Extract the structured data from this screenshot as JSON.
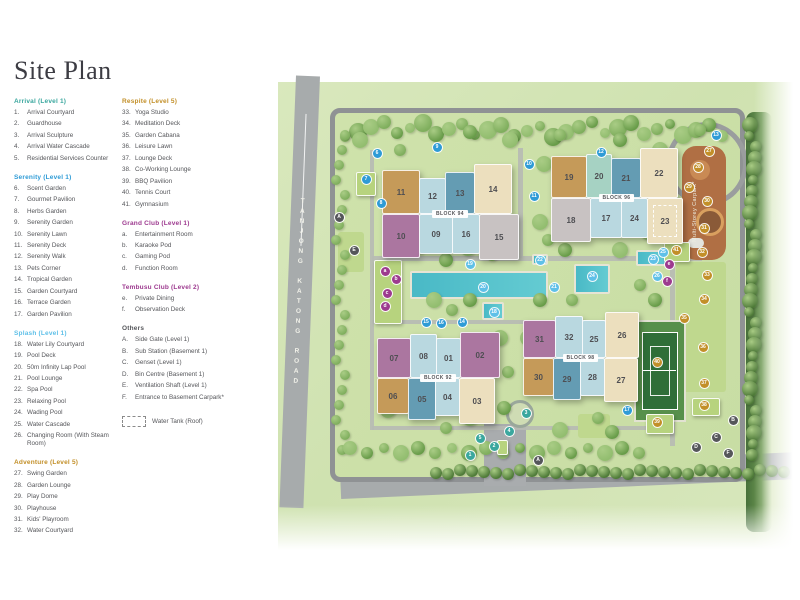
{
  "title": "Site Plan",
  "colors": {
    "arrival": "#3aa79e",
    "serenity": "#2e9bd6",
    "splash": "#5fc0e8",
    "leisure": "#c28f28",
    "club": "#9d3a8f",
    "others": "#55565a",
    "wing_tan": "#c59a59",
    "wing_lightblue": "#b9d8e0",
    "wing_blue": "#649cb3",
    "wing_teal": "#a6d2c3",
    "wing_cream": "#ecdfbe",
    "wing_purple": "#ab76a0",
    "wing_gray": "#c8c2c2"
  },
  "legend": {
    "water_tank_label": "Water Tank (Roof)",
    "columns": [
      [
        {
          "title": "Arrival (Level 1)",
          "color": "arrival",
          "items": [
            [
              "1",
              "Arrival Courtyard"
            ],
            [
              "2",
              "Guardhouse"
            ],
            [
              "3",
              "Arrival Sculpture"
            ],
            [
              "4",
              "Arrival Water Cascade"
            ],
            [
              "5",
              "Residential Services Counter"
            ]
          ]
        },
        {
          "title": "Serenity (Level 1)",
          "color": "serenity",
          "items": [
            [
              "6",
              "Scent Garden"
            ],
            [
              "7",
              "Gourmet Pavilion"
            ],
            [
              "8",
              "Herbs Garden"
            ],
            [
              "9",
              "Serenity Garden"
            ],
            [
              "10",
              "Serenity Lawn"
            ],
            [
              "11",
              "Serenity Deck"
            ],
            [
              "12",
              "Serenity Walk"
            ],
            [
              "13",
              "Pets Corner"
            ],
            [
              "14",
              "Tropical Garden"
            ],
            [
              "15",
              "Garden Courtyard"
            ],
            [
              "16",
              "Terrace Garden"
            ],
            [
              "17",
              "Garden Pavilion"
            ]
          ]
        },
        {
          "title": "Splash (Level 1)",
          "color": "splash",
          "items": [
            [
              "18",
              "Water Lily Courtyard"
            ],
            [
              "19",
              "Pool Deck"
            ],
            [
              "20",
              "50m Infinity Lap Pool"
            ],
            [
              "21",
              "Pool Lounge"
            ],
            [
              "22",
              "Spa Pool"
            ],
            [
              "23",
              "Relaxing Pool"
            ],
            [
              "24",
              "Wading Pool"
            ],
            [
              "25",
              "Water Cascade"
            ],
            [
              "26",
              "Changing Room (With Steam Room)"
            ]
          ]
        },
        {
          "title": "Adventure (Level 5)",
          "color": "leisure",
          "items": [
            [
              "27",
              "Swing Garden"
            ],
            [
              "28",
              "Garden Lounge"
            ],
            [
              "29",
              "Play Dome"
            ],
            [
              "30",
              "Playhouse"
            ],
            [
              "31",
              "Kids' Playroom"
            ],
            [
              "32",
              "Water Courtyard"
            ]
          ]
        }
      ],
      [
        {
          "title": "Respite (Level 5)",
          "color": "leisure",
          "items": [
            [
              "33",
              "Yoga Studio"
            ],
            [
              "34",
              "Meditation Deck"
            ],
            [
              "35",
              "Garden Cabana"
            ],
            [
              "36",
              "Leisure Lawn"
            ],
            [
              "37",
              "Lounge Deck"
            ],
            [
              "38",
              "Co-Working Lounge"
            ],
            [
              "39",
              "BBQ Pavilion"
            ],
            [
              "40",
              "Tennis Court"
            ],
            [
              "41",
              "Gymnasium"
            ]
          ]
        },
        {
          "title": "Grand Club (Level 1)",
          "color": "club",
          "items": [
            [
              "a",
              "Entertainment Room"
            ],
            [
              "b",
              "Karaoke Pod"
            ],
            [
              "c",
              "Gaming Pod"
            ],
            [
              "d",
              "Function Room"
            ]
          ]
        },
        {
          "title": "Tembusu Club (Level 2)",
          "color": "club",
          "items": [
            [
              "e",
              "Private Dining"
            ],
            [
              "f",
              "Observation Deck"
            ]
          ]
        },
        {
          "title": "Others",
          "color": "others",
          "items": [
            [
              "A",
              "Side Gate (Level 1)"
            ],
            [
              "B",
              "Sub Station (Basement 1)"
            ],
            [
              "C",
              "Genset (Level 1)"
            ],
            [
              "D",
              "Bin Centre (Basement 1)"
            ],
            [
              "E",
              "Ventilation Shaft (Level 1)"
            ],
            [
              "F",
              "Entrance to Basement Carpark*"
            ]
          ]
        }
      ]
    ]
  },
  "map": {
    "road_left_label": "TANJONG KATONG ROAD",
    "road_bottom_label": "JALAN TEMBUSU",
    "carpark_label": "Multi-Storey Carpark*",
    "blocks": [
      {
        "name": "BLOCK 94",
        "x": 382,
        "y": 164,
        "top": [
          {
            "n": "11",
            "c": "tan",
            "w": 38,
            "h": 44
          },
          {
            "n": "12",
            "c": "lightblue",
            "w": 27,
            "h": 36
          },
          {
            "n": "13",
            "c": "blue",
            "w": 30,
            "h": 42
          },
          {
            "n": "14",
            "c": "cream",
            "w": 38,
            "h": 50
          }
        ],
        "bottom": [
          {
            "n": "10",
            "c": "purple",
            "w": 38,
            "h": 44
          },
          {
            "n": "09",
            "c": "lightblue",
            "w": 34,
            "h": 40
          },
          {
            "n": "16",
            "c": "lightblue",
            "w": 28,
            "h": 40
          },
          {
            "n": "15",
            "c": "gray",
            "w": 40,
            "h": 46
          }
        ]
      },
      {
        "name": "BLOCK 96",
        "x": 551,
        "y": 148,
        "top": [
          {
            "n": "19",
            "c": "tan",
            "w": 36,
            "h": 42
          },
          {
            "n": "20",
            "c": "teal",
            "w": 26,
            "h": 44
          },
          {
            "n": "21",
            "c": "blue",
            "w": 30,
            "h": 40
          },
          {
            "n": "22",
            "c": "cream",
            "w": 38,
            "h": 50
          }
        ],
        "bottom": [
          {
            "n": "18",
            "c": "gray",
            "w": 40,
            "h": 44
          },
          {
            "n": "17",
            "c": "lightblue",
            "w": 32,
            "h": 40
          },
          {
            "n": "24",
            "c": "lightblue",
            "w": 27,
            "h": 40
          },
          {
            "n": "23",
            "c": "cream",
            "w": 36,
            "h": 46,
            "dashed": true
          }
        ]
      },
      {
        "name": "BLOCK 92",
        "x": 377,
        "y": 332,
        "top": [
          {
            "n": "07",
            "c": "purple",
            "w": 34,
            "h": 40
          },
          {
            "n": "08",
            "c": "lightblue",
            "w": 27,
            "h": 44
          },
          {
            "n": "01",
            "c": "lightblue",
            "w": 25,
            "h": 40
          },
          {
            "n": "02",
            "c": "purple",
            "w": 40,
            "h": 46
          }
        ],
        "bottom": [
          {
            "n": "06",
            "c": "tan",
            "w": 32,
            "h": 36
          },
          {
            "n": "05",
            "c": "blue",
            "w": 28,
            "h": 42
          },
          {
            "n": "04",
            "c": "lightblue",
            "w": 25,
            "h": 38
          },
          {
            "n": "03",
            "c": "cream",
            "w": 36,
            "h": 46
          }
        ]
      },
      {
        "name": "BLOCK 98",
        "x": 523,
        "y": 312,
        "top": [
          {
            "n": "31",
            "c": "purple",
            "w": 33,
            "h": 38
          },
          {
            "n": "32",
            "c": "lightblue",
            "w": 28,
            "h": 42
          },
          {
            "n": "25",
            "c": "lightblue",
            "w": 24,
            "h": 38
          },
          {
            "n": "26",
            "c": "cream",
            "w": 34,
            "h": 46
          }
        ],
        "bottom": [
          {
            "n": "30",
            "c": "tan",
            "w": 31,
            "h": 38
          },
          {
            "n": "29",
            "c": "blue",
            "w": 28,
            "h": 42
          },
          {
            "n": "28",
            "c": "lightblue",
            "w": 25,
            "h": 38
          },
          {
            "n": "27",
            "c": "cream",
            "w": 34,
            "h": 44
          }
        ]
      }
    ],
    "markers": [
      {
        "label": "1",
        "cat": "ar",
        "x": 470,
        "y": 455
      },
      {
        "label": "2",
        "cat": "ar",
        "x": 494,
        "y": 446
      },
      {
        "label": "3",
        "cat": "ar",
        "x": 526,
        "y": 413
      },
      {
        "label": "4",
        "cat": "ar",
        "x": 509,
        "y": 431
      },
      {
        "label": "5",
        "cat": "ar",
        "x": 480,
        "y": 438
      },
      {
        "label": "6",
        "cat": "se",
        "x": 377,
        "y": 153
      },
      {
        "label": "7",
        "cat": "se",
        "x": 366,
        "y": 179
      },
      {
        "label": "8",
        "cat": "se",
        "x": 381,
        "y": 203
      },
      {
        "label": "9",
        "cat": "se",
        "x": 437,
        "y": 147
      },
      {
        "label": "10",
        "cat": "se",
        "x": 529,
        "y": 164
      },
      {
        "label": "11",
        "cat": "se",
        "x": 534,
        "y": 196
      },
      {
        "label": "12",
        "cat": "se",
        "x": 601,
        "y": 152
      },
      {
        "label": "13",
        "cat": "se",
        "x": 716,
        "y": 135
      },
      {
        "label": "14",
        "cat": "se",
        "x": 462,
        "y": 322
      },
      {
        "label": "15",
        "cat": "se",
        "x": 426,
        "y": 322
      },
      {
        "label": "16",
        "cat": "se",
        "x": 441,
        "y": 323
      },
      {
        "label": "17",
        "cat": "se",
        "x": 627,
        "y": 410
      },
      {
        "label": "18",
        "cat": "sp",
        "x": 494,
        "y": 312
      },
      {
        "label": "19",
        "cat": "sp",
        "x": 470,
        "y": 264
      },
      {
        "label": "20",
        "cat": "sp",
        "x": 483,
        "y": 287
      },
      {
        "label": "21",
        "cat": "sp",
        "x": 554,
        "y": 287
      },
      {
        "label": "22",
        "cat": "sp",
        "x": 540,
        "y": 260
      },
      {
        "label": "23",
        "cat": "sp",
        "x": 653,
        "y": 259
      },
      {
        "label": "24",
        "cat": "sp",
        "x": 592,
        "y": 276
      },
      {
        "label": "25",
        "cat": "sp",
        "x": 663,
        "y": 252
      },
      {
        "label": "26",
        "cat": "sp",
        "x": 657,
        "y": 276
      },
      {
        "label": "27",
        "cat": "go",
        "x": 709,
        "y": 151
      },
      {
        "label": "28",
        "cat": "go",
        "x": 698,
        "y": 167
      },
      {
        "label": "29",
        "cat": "go",
        "x": 689,
        "y": 187
      },
      {
        "label": "30",
        "cat": "go",
        "x": 707,
        "y": 201
      },
      {
        "label": "31",
        "cat": "go",
        "x": 704,
        "y": 228
      },
      {
        "label": "32",
        "cat": "go",
        "x": 702,
        "y": 252
      },
      {
        "label": "33",
        "cat": "go",
        "x": 707,
        "y": 275
      },
      {
        "label": "34",
        "cat": "go",
        "x": 704,
        "y": 299
      },
      {
        "label": "35",
        "cat": "go",
        "x": 684,
        "y": 318
      },
      {
        "label": "36",
        "cat": "go",
        "x": 703,
        "y": 347
      },
      {
        "label": "37",
        "cat": "go",
        "x": 704,
        "y": 383
      },
      {
        "label": "38",
        "cat": "go",
        "x": 704,
        "y": 405
      },
      {
        "label": "39",
        "cat": "go",
        "x": 657,
        "y": 422
      },
      {
        "label": "40",
        "cat": "go",
        "x": 657,
        "y": 362
      },
      {
        "label": "41",
        "cat": "go",
        "x": 676,
        "y": 250
      },
      {
        "label": "a",
        "cat": "cl",
        "x": 385,
        "y": 271
      },
      {
        "label": "b",
        "cat": "cl",
        "x": 396,
        "y": 279
      },
      {
        "label": "c",
        "cat": "cl",
        "x": 387,
        "y": 293
      },
      {
        "label": "d",
        "cat": "cl",
        "x": 385,
        "y": 306
      },
      {
        "label": "e",
        "cat": "cl",
        "x": 669,
        "y": 264
      },
      {
        "label": "f",
        "cat": "cl",
        "x": 667,
        "y": 281
      },
      {
        "label": "A",
        "cat": "ot",
        "x": 339,
        "y": 217
      },
      {
        "label": "A",
        "cat": "ot",
        "x": 538,
        "y": 460
      },
      {
        "label": "B",
        "cat": "ot",
        "x": 733,
        "y": 420
      },
      {
        "label": "C",
        "cat": "ot",
        "x": 716,
        "y": 437
      },
      {
        "label": "D",
        "cat": "ot",
        "x": 696,
        "y": 447
      },
      {
        "label": "E",
        "cat": "ot",
        "x": 354,
        "y": 250
      },
      {
        "label": "F",
        "cat": "ot",
        "x": 728,
        "y": 453
      }
    ]
  }
}
